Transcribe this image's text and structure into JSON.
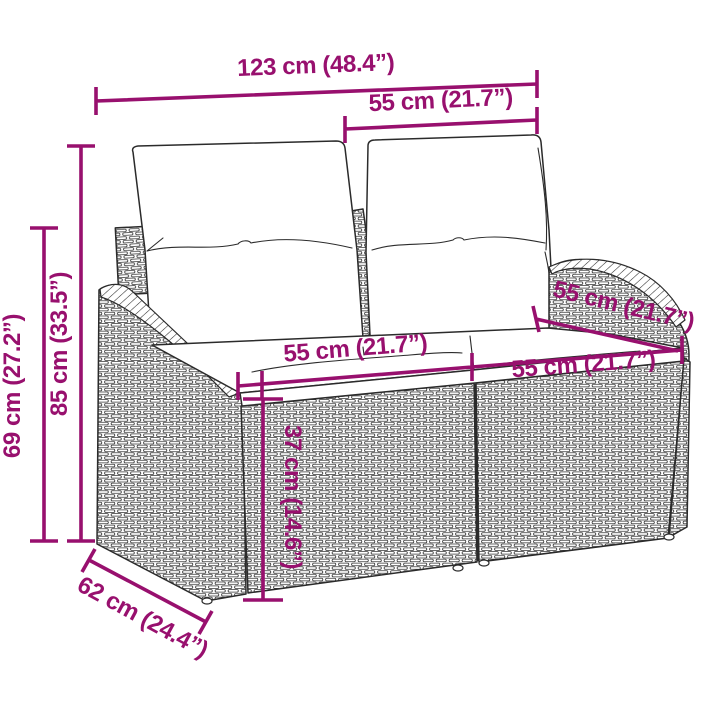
{
  "title": "Garden sofa dimension diagram",
  "colors": {
    "accent": "#98106e",
    "line_art": "#2b2b2b",
    "background": "#ffffff",
    "cushion": "#ffffff"
  },
  "product": {
    "type": "2-seater rattan garden sofa with cushions",
    "parts": [
      "back-cushion-left",
      "back-cushion-right",
      "seat-cushion-left",
      "seat-cushion-right",
      "left-arm",
      "right-arm",
      "wicker-base"
    ]
  },
  "labels": {
    "overall_width": "123 cm (48.4”)",
    "back_section_width": "55 cm (21.7”)",
    "total_height": "85 cm (33.5”)",
    "frame_height": "69 cm (27.2”)",
    "seat_left_width": "55 cm (21.7”)",
    "seat_right_width": "55 cm (21.7”)",
    "arm_depth": "55 cm (21.7”)",
    "base_height": "37 cm (14.6”)",
    "overall_depth": "62 cm (24.4”)"
  }
}
